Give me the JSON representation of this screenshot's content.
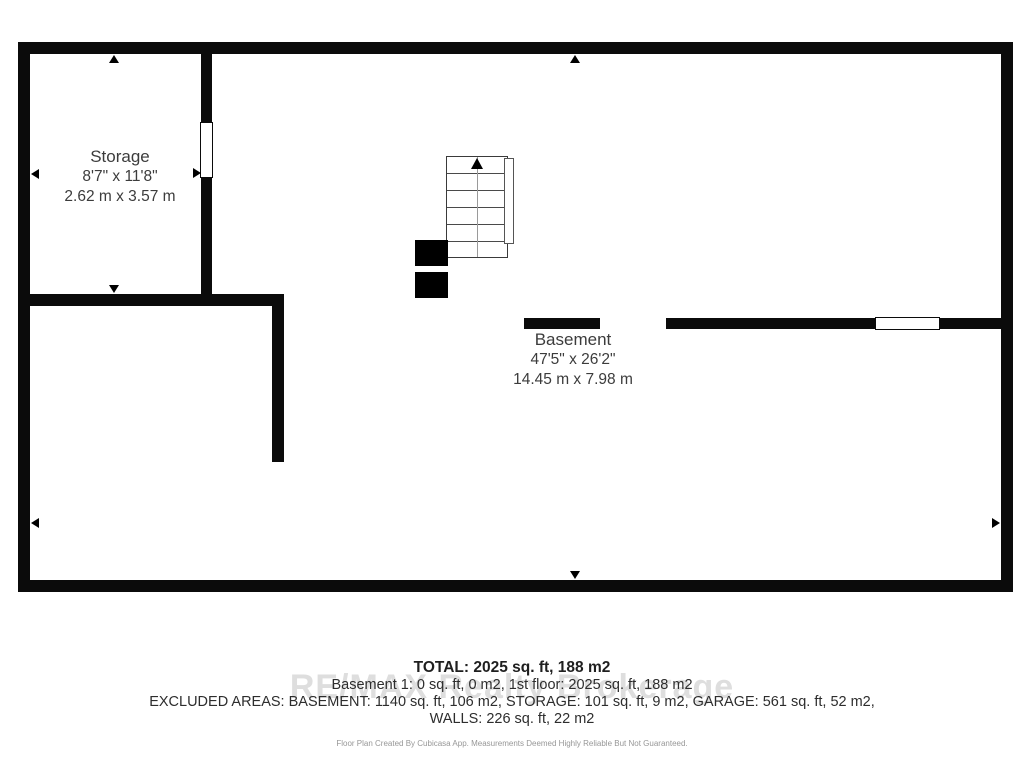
{
  "floor_plan": {
    "wall_color": "#0b0b0b",
    "rooms": [
      {
        "name": "Storage",
        "dims_imperial": "8'7\" x 11'8\"",
        "dims_metric": "2.62 m x 3.57 m"
      },
      {
        "name": "Basement",
        "dims_imperial": "47'5\" x 26'2\"",
        "dims_metric": "14.45 m x 7.98 m"
      }
    ],
    "icons": {
      "stairs_direction": "up-arrow",
      "dimension_markers": [
        "up-arrow",
        "down-arrow",
        "left-arrow",
        "right-arrow"
      ]
    }
  },
  "summary": {
    "total": "TOTAL: 2025 sq. ft, 188 m2",
    "floors": "Basement 1: 0 sq. ft, 0 m2, 1st floor: 2025 sq. ft, 188 m2",
    "excluded": "EXCLUDED AREAS: BASEMENT: 1140 sq. ft, 106 m2, STORAGE: 101 sq. ft, 9 m2, GARAGE: 561 sq. ft, 52 m2,",
    "walls": "WALLS: 226 sq. ft, 22 m2",
    "watermark": "RE/MAX Realty Brokerage",
    "disclaimer": "Floor Plan Created By Cubicasa App. Measurements Deemed Highly Reliable But Not Guaranteed."
  }
}
